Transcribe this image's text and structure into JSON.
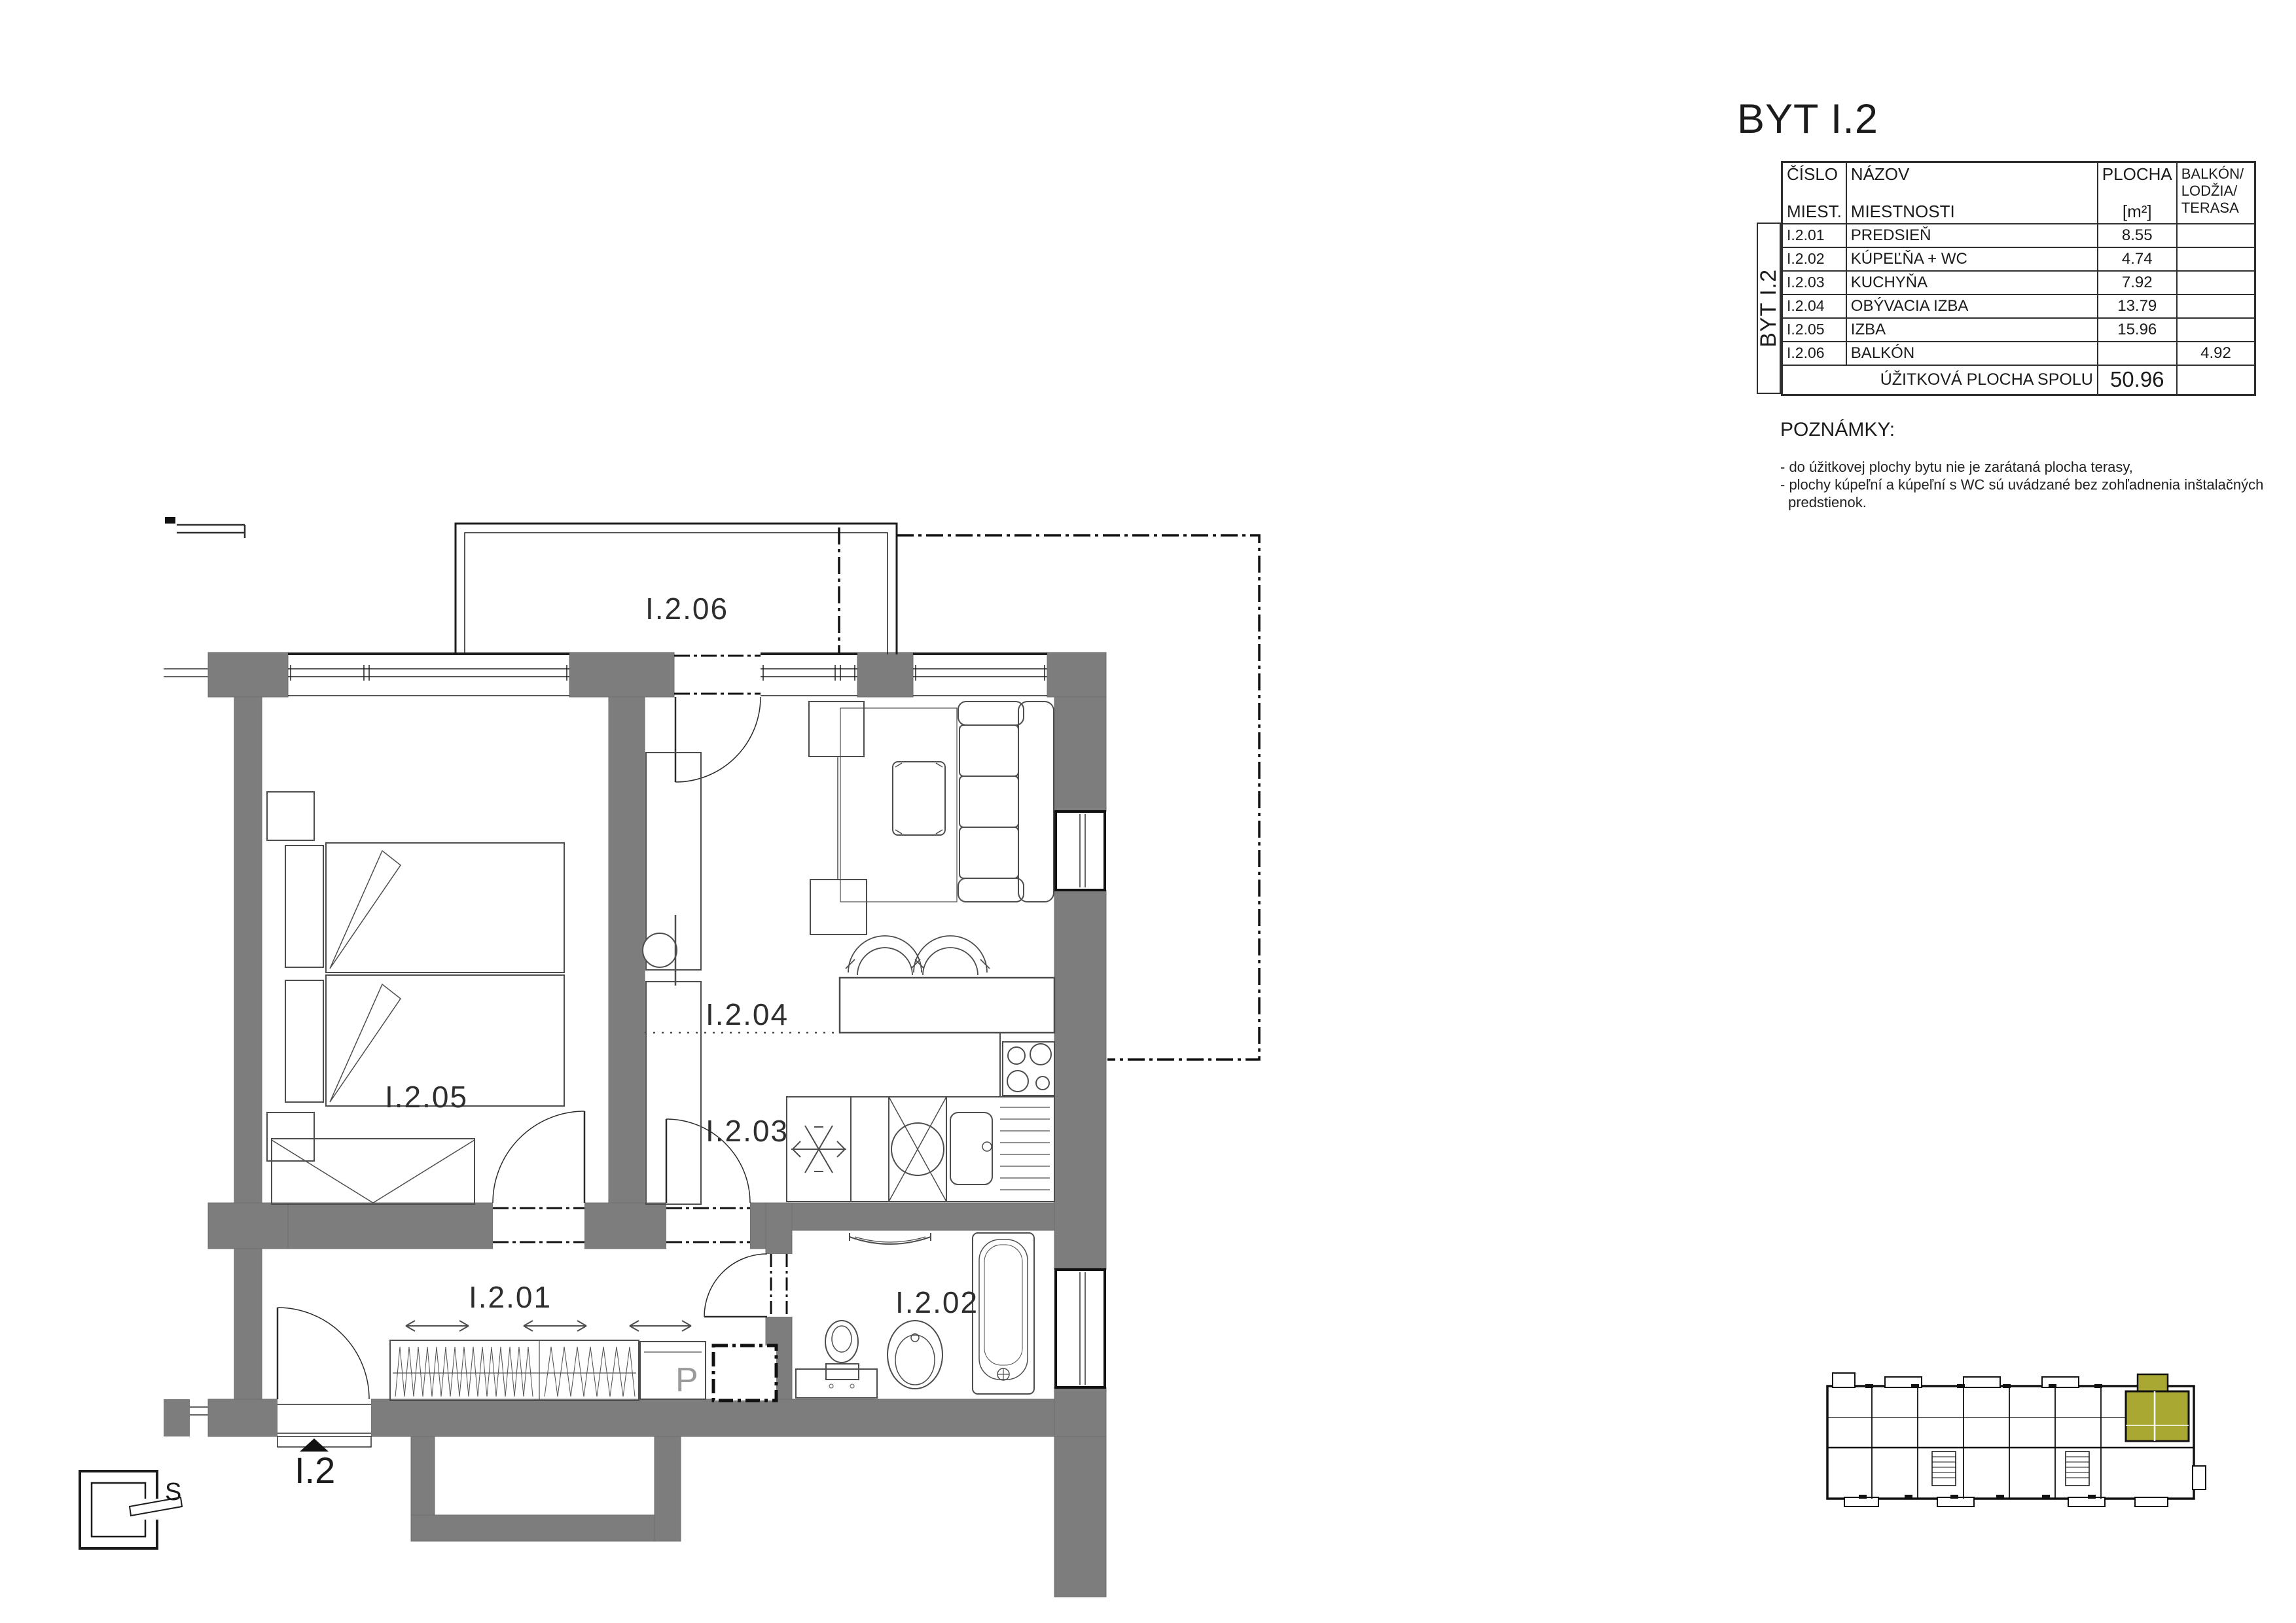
{
  "title": "BYT I.2",
  "table": {
    "headers": {
      "col1_line1": "ČÍSLO",
      "col1_line2": "MIEST.",
      "col2_line1": "NÁZOV",
      "col2_line2": "MIESTNOSTI",
      "col3_line1": "PLOCHA",
      "col3_line2": "[m²]",
      "col4_line1": "BALKÓN/",
      "col4_line2": "LODŽIA/",
      "col4_line3": "TERASA"
    },
    "side_label": "BYT I.2",
    "rows": [
      {
        "number": "I.2.01",
        "name": "PREDSIEŇ",
        "area": "8.55",
        "balcony": ""
      },
      {
        "number": "I.2.02",
        "name": "KÚPEĽŇA + WC",
        "area": "4.74",
        "balcony": ""
      },
      {
        "number": "I.2.03",
        "name": "KUCHYŇA",
        "area": "7.92",
        "balcony": ""
      },
      {
        "number": "I.2.04",
        "name": "OBÝVACIA IZBA",
        "area": "13.79",
        "balcony": ""
      },
      {
        "number": "I.2.05",
        "name": "IZBA",
        "area": "15.96",
        "balcony": ""
      },
      {
        "number": "I.2.06",
        "name": "BALKÓN",
        "area": "",
        "balcony": "4.92"
      }
    ],
    "total_label": "ÚŽITKOVÁ PLOCHA SPOLU",
    "total_value": "50.96"
  },
  "notes": {
    "title": "POZNÁMKY:",
    "line1": "- do úžitkovej plochy bytu nie je zarátaná plocha terasy,",
    "line2": "- plochy kúpeľní a kúpeľní s WC sú uvádzané bez zohľadnenia inštalačných",
    "line3": "predstienok."
  },
  "plan": {
    "room_labels": {
      "hall": "I.2.01",
      "bathroom": "I.2.02",
      "kitchen": "I.2.03",
      "living": "I.2.04",
      "bedroom": "I.2.05",
      "balcony": "I.2.06"
    },
    "entrance_marker": "I.2",
    "compass_letter": "S",
    "washer_letter": "P"
  },
  "colors": {
    "wall_gray": "#7D7D7D",
    "unit_highlight": "#A9A833"
  }
}
